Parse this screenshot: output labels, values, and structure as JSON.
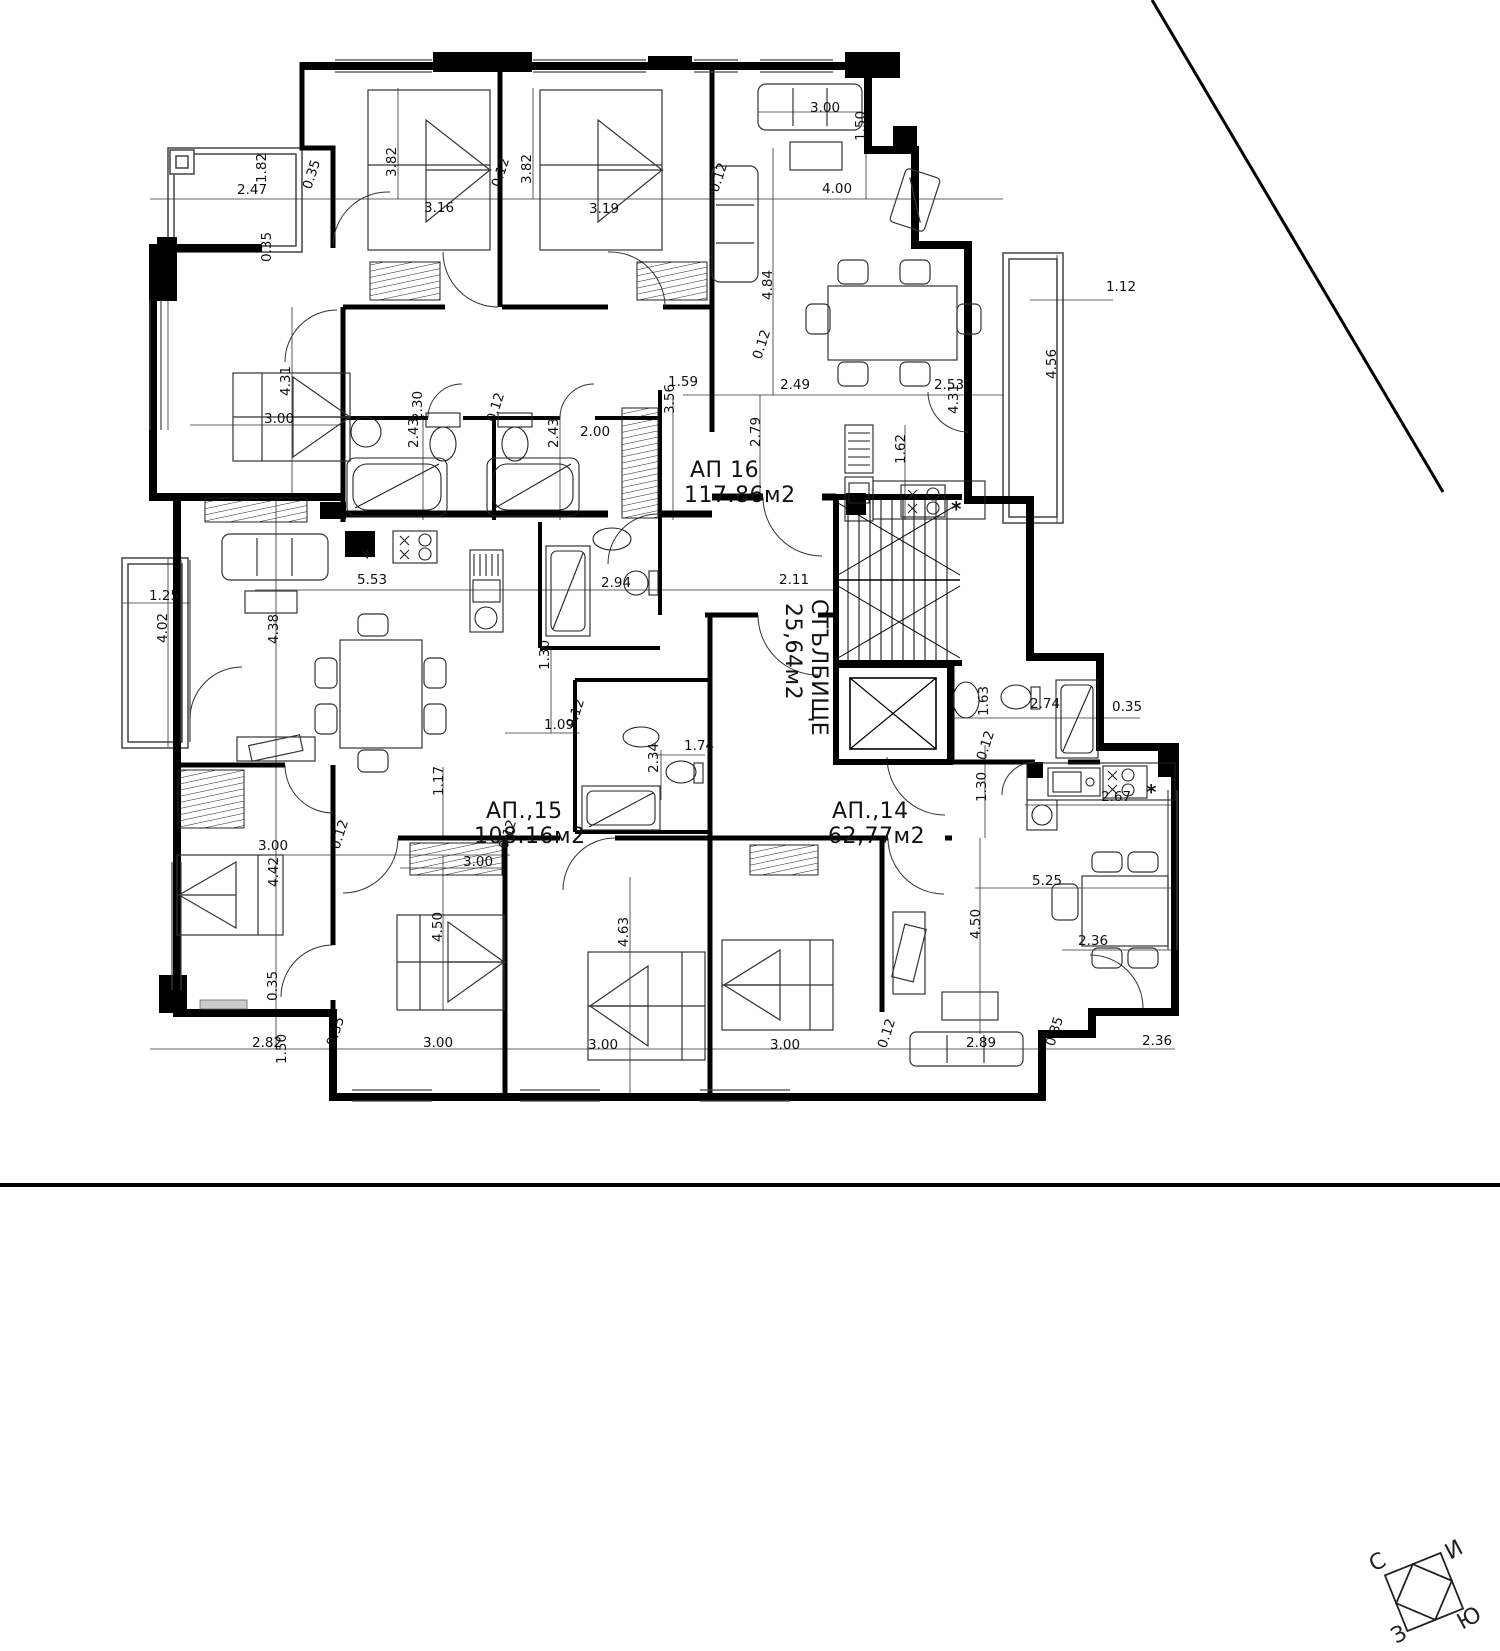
{
  "document": {
    "kind": "architectural floor plan",
    "area_unit": "м2"
  },
  "apartments": [
    {
      "name": "АП  16",
      "area": "117.86м2"
    },
    {
      "name": "АП.,15",
      "area": "108.16м2"
    },
    {
      "name": "АП.,14",
      "area": "62,77м2"
    },
    {
      "name": "СТЪЛБИЩЕ",
      "area": "25,64м2"
    }
  ],
  "compass": {
    "north": "С",
    "east": "И",
    "south": "Ю",
    "west": "З"
  },
  "labels": [
    {
      "t": "АП  16",
      "x": 690,
      "y": 477,
      "c": "room"
    },
    {
      "t": "117.86м2",
      "x": 684,
      "y": 502,
      "c": "room"
    },
    {
      "t": "АП.,15",
      "x": 486,
      "y": 818,
      "c": "room"
    },
    {
      "t": "108.16м2",
      "x": 474,
      "y": 843,
      "c": "room"
    },
    {
      "t": "АП.,14",
      "x": 832,
      "y": 818,
      "c": "room"
    },
    {
      "t": "62,77м2",
      "x": 828,
      "y": 843,
      "c": "room"
    },
    {
      "t": "СТЪЛБИЩЕ",
      "x": 812,
      "y": 599,
      "r": 90,
      "c": "room"
    },
    {
      "t": "25,64м2",
      "x": 786,
      "y": 603,
      "r": 90,
      "c": "room"
    },
    {
      "t": "С",
      "x": 1374,
      "y": 1572,
      "r": -28,
      "c": "comp"
    },
    {
      "t": "И",
      "x": 1450,
      "y": 1560,
      "r": -28,
      "c": "comp"
    },
    {
      "t": "З",
      "x": 1396,
      "y": 1644,
      "r": -28,
      "c": "comp"
    },
    {
      "t": "Ю",
      "x": 1462,
      "y": 1630,
      "r": -28,
      "c": "comp"
    },
    {
      "t": "*",
      "x": 362,
      "y": 564,
      "c": "sym"
    },
    {
      "t": "*",
      "x": 951,
      "y": 516,
      "c": "sym"
    },
    {
      "t": "*",
      "x": 1146,
      "y": 799,
      "c": "sym"
    },
    {
      "t": "2.47",
      "x": 237,
      "y": 194
    },
    {
      "t": "1.82",
      "x": 266,
      "y": 183,
      "r": -90
    },
    {
      "t": "0.35",
      "x": 311,
      "y": 190,
      "r": -72
    },
    {
      "t": "3.82",
      "x": 396,
      "y": 177,
      "r": -90
    },
    {
      "t": "3.16",
      "x": 424,
      "y": 212
    },
    {
      "t": "3.82",
      "x": 531,
      "y": 184,
      "r": -90
    },
    {
      "t": "3.19",
      "x": 589,
      "y": 213
    },
    {
      "t": "0.12",
      "x": 500,
      "y": 188,
      "r": -72
    },
    {
      "t": "0.12",
      "x": 718,
      "y": 193,
      "r": -72
    },
    {
      "t": "3.00",
      "x": 810,
      "y": 112
    },
    {
      "t": "1.50",
      "x": 865,
      "y": 141,
      "r": -90
    },
    {
      "t": "4.00",
      "x": 822,
      "y": 193
    },
    {
      "t": "4.84",
      "x": 772,
      "y": 300,
      "r": -90
    },
    {
      "t": "1.12",
      "x": 1106,
      "y": 291
    },
    {
      "t": "4.56",
      "x": 1056,
      "y": 379,
      "r": -90
    },
    {
      "t": "2.49",
      "x": 780,
      "y": 389
    },
    {
      "t": "2.53",
      "x": 934,
      "y": 389
    },
    {
      "t": "4.31",
      "x": 958,
      "y": 414,
      "r": -90
    },
    {
      "t": "0.12",
      "x": 761,
      "y": 360,
      "r": -72
    },
    {
      "t": "1.59",
      "x": 668,
      "y": 386
    },
    {
      "t": "3.56",
      "x": 674,
      "y": 414,
      "r": -90
    },
    {
      "t": "2.79",
      "x": 760,
      "y": 447,
      "r": -90
    },
    {
      "t": "4.31",
      "x": 290,
      "y": 396,
      "r": -90
    },
    {
      "t": "3.00",
      "x": 264,
      "y": 423
    },
    {
      "t": "0.35",
      "x": 271,
      "y": 262,
      "r": -90
    },
    {
      "t": "2.30",
      "x": 422,
      "y": 421,
      "r": -90
    },
    {
      "t": "2.43",
      "x": 418,
      "y": 448,
      "r": -90
    },
    {
      "t": "0.12",
      "x": 495,
      "y": 423,
      "r": -72
    },
    {
      "t": "2.43",
      "x": 558,
      "y": 448,
      "r": -90
    },
    {
      "t": "2.00",
      "x": 580,
      "y": 436
    },
    {
      "t": "1.62",
      "x": 905,
      "y": 464,
      "r": -90
    },
    {
      "t": "5.53",
      "x": 357,
      "y": 584
    },
    {
      "t": "2.94",
      "x": 601,
      "y": 587
    },
    {
      "t": "2.11",
      "x": 779,
      "y": 584
    },
    {
      "t": "1.25",
      "x": 149,
      "y": 600
    },
    {
      "t": "4.02",
      "x": 167,
      "y": 643,
      "r": -90
    },
    {
      "t": "4.38",
      "x": 278,
      "y": 644,
      "r": -90
    },
    {
      "t": "1.30",
      "x": 549,
      "y": 670,
      "r": -90
    },
    {
      "t": "1.09",
      "x": 544,
      "y": 729
    },
    {
      "t": "0.12",
      "x": 575,
      "y": 729,
      "r": -72
    },
    {
      "t": "1.74",
      "x": 684,
      "y": 750
    },
    {
      "t": "2.34",
      "x": 658,
      "y": 773,
      "r": -90
    },
    {
      "t": "1.17",
      "x": 443,
      "y": 796,
      "r": -90
    },
    {
      "t": "2.74",
      "x": 1030,
      "y": 708
    },
    {
      "t": "1.63",
      "x": 988,
      "y": 716,
      "r": -90
    },
    {
      "t": "0.35",
      "x": 1112,
      "y": 711
    },
    {
      "t": "0.12",
      "x": 985,
      "y": 761,
      "r": -72
    },
    {
      "t": "1.30",
      "x": 986,
      "y": 802,
      "r": -90
    },
    {
      "t": "2.67",
      "x": 1101,
      "y": 801
    },
    {
      "t": "5.25",
      "x": 1032,
      "y": 885
    },
    {
      "t": "4.50",
      "x": 980,
      "y": 939,
      "r": -90
    },
    {
      "t": "2.36",
      "x": 1078,
      "y": 945
    },
    {
      "t": "3.00",
      "x": 258,
      "y": 850
    },
    {
      "t": "0.12",
      "x": 339,
      "y": 850,
      "r": -72
    },
    {
      "t": "4.42",
      "x": 278,
      "y": 887,
      "r": -90
    },
    {
      "t": "3.00",
      "x": 463,
      "y": 866
    },
    {
      "t": "0.12",
      "x": 507,
      "y": 850,
      "r": -72
    },
    {
      "t": "4.50",
      "x": 442,
      "y": 942,
      "r": -90
    },
    {
      "t": "4.63",
      "x": 628,
      "y": 947,
      "r": -90
    },
    {
      "t": "2.82",
      "x": 252,
      "y": 1047
    },
    {
      "t": "0.35",
      "x": 335,
      "y": 1047,
      "r": -72
    },
    {
      "t": "1.50",
      "x": 286,
      "y": 1064,
      "r": -90
    },
    {
      "t": "3.00",
      "x": 423,
      "y": 1047
    },
    {
      "t": "3.00",
      "x": 588,
      "y": 1049
    },
    {
      "t": "3.00",
      "x": 770,
      "y": 1049
    },
    {
      "t": "0.12",
      "x": 886,
      "y": 1049,
      "r": -72
    },
    {
      "t": "2.89",
      "x": 966,
      "y": 1047
    },
    {
      "t": "0.35",
      "x": 1054,
      "y": 1047,
      "r": -72
    },
    {
      "t": "2.36",
      "x": 1142,
      "y": 1045
    },
    {
      "t": "0.35",
      "x": 277,
      "y": 1001,
      "r": -90
    }
  ]
}
